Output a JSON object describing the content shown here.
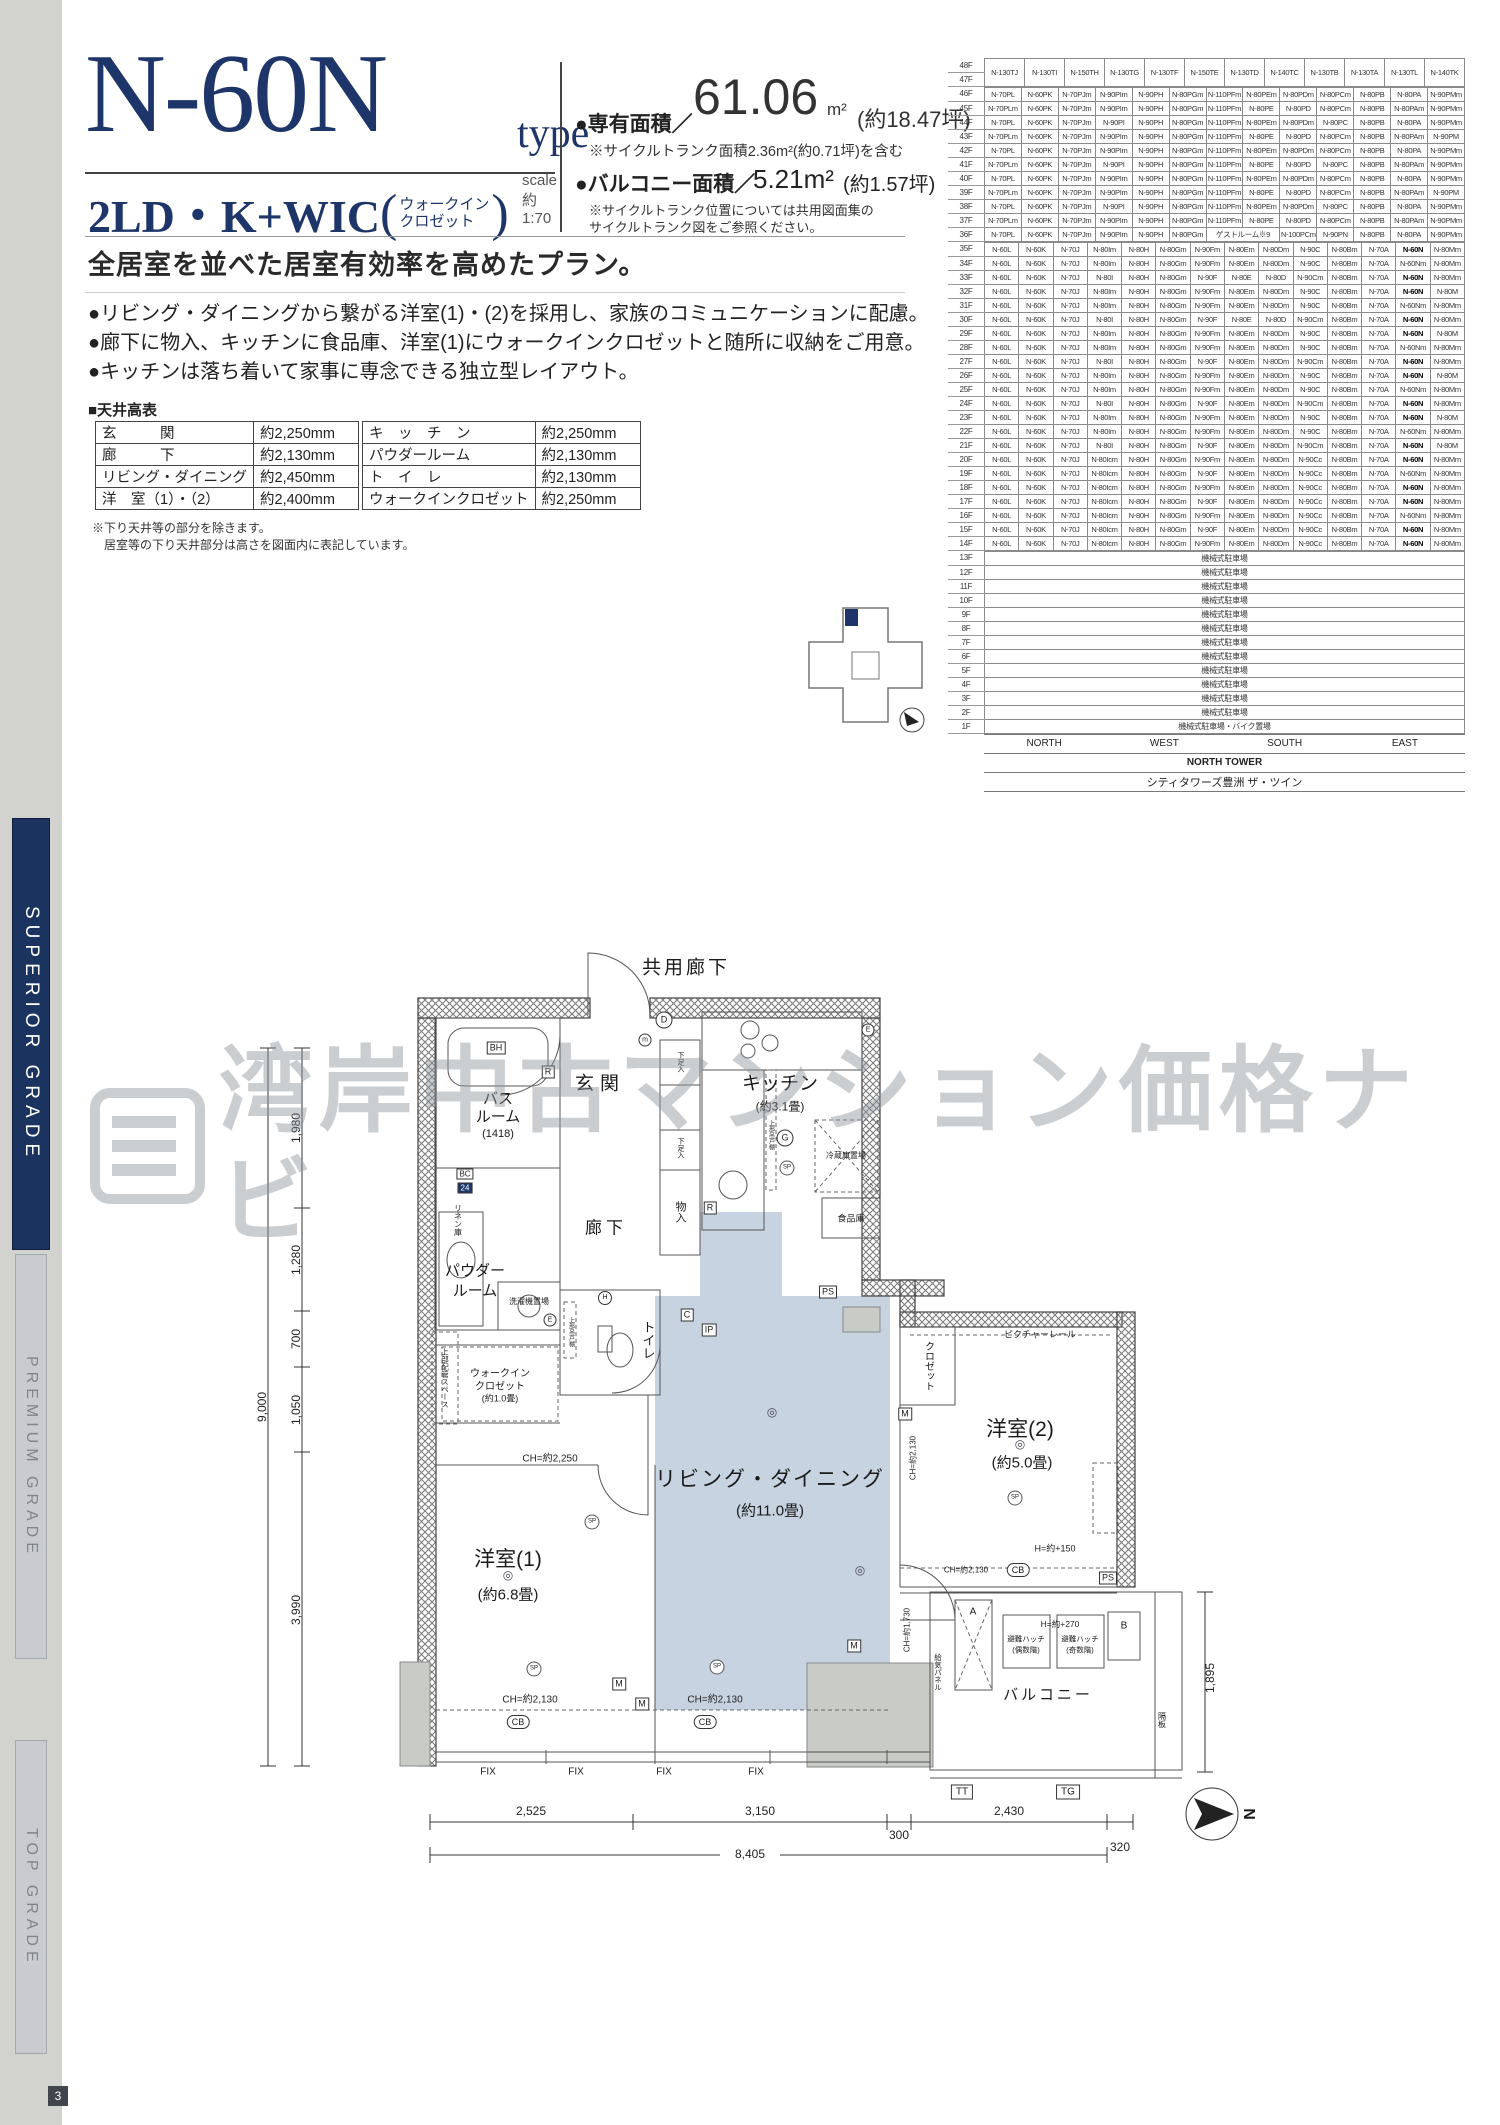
{
  "page": {
    "number": "3"
  },
  "sidebar": {
    "bands": [
      {
        "label": "SUPERIOR GRADE"
      },
      {
        "label": "PREMIUM GRADE"
      },
      {
        "label": "TOP GRADE"
      }
    ]
  },
  "header": {
    "type_name": "N-60N",
    "type_suffix": "type",
    "scale": "scale 約1:70",
    "layout": "2LD・K+WIC",
    "paren_open": "(",
    "paren_close": ")",
    "layout_paren_line1": "ウォークイン",
    "layout_paren_line2": "クロゼット",
    "area_label": "●専有面積／",
    "area_value": "61.06",
    "area_unit": "m²",
    "area_tsubo": "(約18.47坪)",
    "area_note": "※サイクルトランク面積2.36m²(約0.71坪)を含む",
    "balcony_label": "●バルコニー面積／",
    "balcony_value": "5.21m²",
    "balcony_tsubo": "(約1.57坪)",
    "balcony_note1": "※サイクルトランク位置については共用図面集の",
    "balcony_note2": "サイクルトランク図をご参照ください。"
  },
  "description": {
    "headline": "全居室を並べた居室有効率を高めたプラン。",
    "bullets": [
      "●リビング・ダイニングから繋がる洋室(1)・(2)を採用し、家族のコミュニケーションに配慮。",
      "●廊下に物入、キッチンに食品庫、洋室(1)にウォークインクロゼットと随所に収納をご用意。",
      "●キッチンは落ち着いて家事に専念できる独立型レイアウト。"
    ]
  },
  "ceiling_table": {
    "title": "■天井高表",
    "left_rows": [
      [
        "玄　　　関",
        "約2,250mm"
      ],
      [
        "廊　　　下",
        "約2,130mm"
      ],
      [
        "リビング・ダイニング",
        "約2,450mm"
      ],
      [
        "洋　室（1）・（2）",
        "約2,400mm"
      ]
    ],
    "right_rows": [
      [
        "キ　ッ　チ　ン",
        "約2,250mm"
      ],
      [
        "パウダールーム",
        "約2,130mm"
      ],
      [
        "ト　イ　レ",
        "約2,130mm"
      ],
      [
        "ウォークインクロゼット",
        "約2,250mm"
      ]
    ],
    "notes": [
      "※下り天井等の部分を除きます。",
      "　居室等の下り天井部分は高さを図面内に表記しています。"
    ]
  },
  "floor_table": {
    "highlight": "N-60N",
    "penthouse": {
      "floors": [
        "48F",
        "47F"
      ],
      "cells": [
        "N-130TJ",
        "N-130TI",
        "N-150TH",
        "N-130TG",
        "N-130TF",
        "N-150TE",
        "N-130TD",
        "N-140TC",
        "N-130TB",
        "N-130TA",
        "N-130TL",
        "N-140TK"
      ]
    },
    "rows_upper": [
      {
        "floor": "46F",
        "cells": [
          "N-70PL",
          "N-60PK",
          "N-70PJm",
          "N-90PIm",
          "N-90PH",
          "N-80PGm",
          "N-110PFm",
          "N-80PEm",
          "N-80PDm",
          "N-80PCm",
          "N-80PB",
          "N-80PA",
          "N-90PMm"
        ]
      },
      {
        "floor": "45F",
        "cells": [
          "N-70PLm",
          "N-60PK",
          "N-70PJm",
          "N-90PIm",
          "N-90PH",
          "N-80PGm",
          "N-110PFm",
          "N-80PE",
          "N-80PD",
          "N-80PCm",
          "N-80PB",
          "N-80PAm",
          "N-90PMm"
        ]
      },
      {
        "floor": "44F",
        "cells": [
          "N-70PL",
          "N-60PK",
          "N-70PJm",
          "N-90PI",
          "N-90PH",
          "N-80PGm",
          "N-110PFm",
          "N-80PEm",
          "N-80PDm",
          "N-80PC",
          "N-80PB",
          "N-80PA",
          "N-90PMm"
        ]
      },
      {
        "floor": "43F",
        "cells": [
          "N-70PLm",
          "N-60PK",
          "N-70PJm",
          "N-90PIm",
          "N-90PH",
          "N-80PGm",
          "N-110PFm",
          "N-80PE",
          "N-80PD",
          "N-80PCm",
          "N-80PB",
          "N-80PAm",
          "N-90PM"
        ]
      },
      {
        "floor": "42F",
        "cells": [
          "N-70PL",
          "N-60PK",
          "N-70PJm",
          "N-90PIm",
          "N-90PH",
          "N-80PGm",
          "N-110PFm",
          "N-80PEm",
          "N-80PDm",
          "N-80PCm",
          "N-80PB",
          "N-80PA",
          "N-90PMm"
        ]
      },
      {
        "floor": "41F",
        "cells": [
          "N-70PLm",
          "N-60PK",
          "N-70PJm",
          "N-90PI",
          "N-90PH",
          "N-80PGm",
          "N-110PFm",
          "N-80PE",
          "N-80PD",
          "N-80PC",
          "N-80PB",
          "N-80PAm",
          "N-90PMm"
        ]
      },
      {
        "floor": "40F",
        "cells": [
          "N-70PL",
          "N-60PK",
          "N-70PJm",
          "N-90PIm",
          "N-90PH",
          "N-80PGm",
          "N-110PFm",
          "N-80PEm",
          "N-80PDm",
          "N-80PCm",
          "N-80PB",
          "N-80PA",
          "N-90PMm"
        ]
      },
      {
        "floor": "39F",
        "cells": [
          "N-70PLm",
          "N-60PK",
          "N-70PJm",
          "N-90PIm",
          "N-90PH",
          "N-80PGm",
          "N-110PFm",
          "N-80PE",
          "N-80PD",
          "N-80PCm",
          "N-80PB",
          "N-80PAm",
          "N-90PM"
        ]
      },
      {
        "floor": "38F",
        "cells": [
          "N-70PL",
          "N-60PK",
          "N-70PJm",
          "N-90PI",
          "N-90PH",
          "N-80PGm",
          "N-110PFm",
          "N-80PEm",
          "N-80PDm",
          "N-80PC",
          "N-80PB",
          "N-80PA",
          "N-90PMm"
        ]
      },
      {
        "floor": "37F",
        "cells": [
          "N-70PLm",
          "N-60PK",
          "N-70PJm",
          "N-90PIm",
          "N-90PH",
          "N-80PGm",
          "N-110PFm",
          "N-80PE",
          "N-80PD",
          "N-80PCm",
          "N-80PB",
          "N-80PAm",
          "N-90PMm"
        ]
      },
      {
        "floor": "36F",
        "cells": [
          "N-70PL",
          "N-60PK",
          "N-70PJm",
          "N-90PIm",
          "N-90PH",
          "N-80PGm",
          {
            "t": "ゲストルーム※9",
            "s": 2
          },
          "N-100PCm",
          "N-90PN",
          "N-80PB",
          "N-80PA",
          "N-90PMm"
        ]
      }
    ],
    "rows_lower": [
      {
        "floor": "35F",
        "cells": [
          "N-60L",
          "N-60K",
          "N-70J",
          "N-80Im",
          "N-80H",
          "N-80Gm",
          "N-90Fm",
          "N-80Em",
          "N-80Dm",
          "N-90C",
          "N-80Bm",
          "N-70A",
          "N-60N",
          "N-80Mm"
        ]
      },
      {
        "floor": "34F",
        "cells": [
          "N-60L",
          "N-60K",
          "N-70J",
          "N-80Im",
          "N-80H",
          "N-80Gm",
          "N-90Fm",
          "N-80Em",
          "N-80Dm",
          "N-90C",
          "N-80Bm",
          "N-70A",
          "N-60Nm",
          "N-80Mm"
        ]
      },
      {
        "floor": "33F",
        "cells": [
          "N-60L",
          "N-60K",
          "N-70J",
          "N-80I",
          "N-80H",
          "N-80Gm",
          "N-90F",
          "N-80E",
          "N-80D",
          "N-90Cm",
          "N-80Bm",
          "N-70A",
          "N-60N",
          "N-80Mm"
        ]
      },
      {
        "floor": "32F",
        "cells": [
          "N-60L",
          "N-60K",
          "N-70J",
          "N-80Im",
          "N-80H",
          "N-80Gm",
          "N-90Fm",
          "N-80Em",
          "N-80Dm",
          "N-90C",
          "N-80Bm",
          "N-70A",
          "N-60N",
          "N-80M"
        ]
      },
      {
        "floor": "31F",
        "cells": [
          "N-60L",
          "N-60K",
          "N-70J",
          "N-80Im",
          "N-80H",
          "N-80Gm",
          "N-90Fm",
          "N-80Em",
          "N-80Dm",
          "N-90C",
          "N-80Bm",
          "N-70A",
          "N-60Nm",
          "N-80Mm"
        ]
      },
      {
        "floor": "30F",
        "cells": [
          "N-60L",
          "N-60K",
          "N-70J",
          "N-80I",
          "N-80H",
          "N-80Gm",
          "N-90F",
          "N-80E",
          "N-80D",
          "N-90Cm",
          "N-80Bm",
          "N-70A",
          "N-60N",
          "N-80Mm"
        ]
      },
      {
        "floor": "29F",
        "cells": [
          "N-60L",
          "N-60K",
          "N-70J",
          "N-80Im",
          "N-80H",
          "N-80Gm",
          "N-90Fm",
          "N-80Em",
          "N-80Dm",
          "N-90C",
          "N-80Bm",
          "N-70A",
          "N-60N",
          "N-80M"
        ]
      },
      {
        "floor": "28F",
        "cells": [
          "N-60L",
          "N-60K",
          "N-70J",
          "N-80Im",
          "N-80H",
          "N-80Gm",
          "N-90Fm",
          "N-80Em",
          "N-80Dm",
          "N-90C",
          "N-80Bm",
          "N-70A",
          "N-60Nm",
          "N-80Mm"
        ]
      },
      {
        "floor": "27F",
        "cells": [
          "N-60L",
          "N-60K",
          "N-70J",
          "N-80I",
          "N-80H",
          "N-80Gm",
          "N-90F",
          "N-80Em",
          "N-80Dm",
          "N-90Cm",
          "N-80Bm",
          "N-70A",
          "N-60N",
          "N-80Mm"
        ]
      },
      {
        "floor": "26F",
        "cells": [
          "N-60L",
          "N-60K",
          "N-70J",
          "N-80Im",
          "N-80H",
          "N-80Gm",
          "N-90Fm",
          "N-80Em",
          "N-80Dm",
          "N-90C",
          "N-80Bm",
          "N-70A",
          "N-60N",
          "N-80M"
        ]
      },
      {
        "floor": "25F",
        "cells": [
          "N-60L",
          "N-60K",
          "N-70J",
          "N-80Im",
          "N-80H",
          "N-80Gm",
          "N-90Fm",
          "N-80Em",
          "N-80Dm",
          "N-90C",
          "N-80Bm",
          "N-70A",
          "N-60Nm",
          "N-80Mm"
        ]
      },
      {
        "floor": "24F",
        "cells": [
          "N-60L",
          "N-60K",
          "N-70J",
          "N-80I",
          "N-80H",
          "N-80Gm",
          "N-90F",
          "N-80Em",
          "N-80Dm",
          "N-90Cm",
          "N-80Bm",
          "N-70A",
          "N-60N",
          "N-80Mm"
        ]
      },
      {
        "floor": "23F",
        "cells": [
          "N-60L",
          "N-60K",
          "N-70J",
          "N-80Im",
          "N-80H",
          "N-80Gm",
          "N-90Fm",
          "N-80Em",
          "N-80Dm",
          "N-90C",
          "N-80Bm",
          "N-70A",
          "N-60N",
          "N-80M"
        ]
      },
      {
        "floor": "22F",
        "cells": [
          "N-60L",
          "N-60K",
          "N-70J",
          "N-80Im",
          "N-80H",
          "N-80Gm",
          "N-90Fm",
          "N-80Em",
          "N-80Dm",
          "N-90C",
          "N-80Bm",
          "N-70A",
          "N-60Nm",
          "N-80Mm"
        ]
      },
      {
        "floor": "21F",
        "cells": [
          "N-60L",
          "N-60K",
          "N-70J",
          "N-80I",
          "N-80H",
          "N-80Gm",
          "N-90F",
          "N-80Em",
          "N-80Dm",
          "N-90Cm",
          "N-80Bm",
          "N-70A",
          "N-60N",
          "N-80M"
        ]
      },
      {
        "floor": "20F",
        "cells": [
          "N-60L",
          "N-60K",
          "N-70J",
          "N-80Icm",
          "N-80H",
          "N-80Gm",
          "N-90Fm",
          "N-80Em",
          "N-80Dm",
          "N-90Cc",
          "N-80Bm",
          "N-70A",
          "N-60N",
          "N-80Mm"
        ]
      },
      {
        "floor": "19F",
        "cells": [
          "N-60L",
          "N-60K",
          "N-70J",
          "N-80Icm",
          "N-80H",
          "N-80Gm",
          "N-90F",
          "N-80Em",
          "N-80Dm",
          "N-90Cc",
          "N-80Bm",
          "N-70A",
          "N-60Nm",
          "N-80Mm"
        ]
      },
      {
        "floor": "18F",
        "cells": [
          "N-60L",
          "N-60K",
          "N-70J",
          "N-80Icm",
          "N-80H",
          "N-80Gm",
          "N-90Fm",
          "N-80Em",
          "N-80Dm",
          "N-90Cc",
          "N-80Bm",
          "N-70A",
          "N-60N",
          "N-80Mm"
        ]
      },
      {
        "floor": "17F",
        "cells": [
          "N-60L",
          "N-60K",
          "N-70J",
          "N-80Icm",
          "N-80H",
          "N-80Gm",
          "N-90F",
          "N-80Em",
          "N-80Dm",
          "N-90Cc",
          "N-80Bm",
          "N-70A",
          "N-60N",
          "N-80Mm"
        ]
      },
      {
        "floor": "16F",
        "cells": [
          "N-60L",
          "N-60K",
          "N-70J",
          "N-80Icm",
          "N-80H",
          "N-80Gm",
          "N-90Fm",
          "N-80Em",
          "N-80Dm",
          "N-90Cc",
          "N-80Bm",
          "N-70A",
          "N-60Nm",
          "N-80Mm"
        ]
      },
      {
        "floor": "15F",
        "cells": [
          "N-60L",
          "N-60K",
          "N-70J",
          "N-80Icm",
          "N-80H",
          "N-80Gm",
          "N-90F",
          "N-80Em",
          "N-80Dm",
          "N-90Cc",
          "N-80Bm",
          "N-70A",
          "N-60N",
          "N-80Mm"
        ]
      },
      {
        "floor": "14F",
        "cells": [
          "N-60L",
          "N-60K",
          "N-70J",
          "N-80Icm",
          "N-80H",
          "N-80Gm",
          "N-90Fm",
          "N-80Em",
          "N-80Dm",
          "N-90Cc",
          "N-80Bm",
          "N-70A",
          "N-60N",
          "N-80Mm"
        ]
      }
    ],
    "parking_rows": [
      {
        "floor": "13F",
        "label": "機械式駐車場"
      },
      {
        "floor": "12F",
        "label": "機械式駐車場"
      },
      {
        "floor": "11F",
        "label": "機械式駐車場"
      },
      {
        "floor": "10F",
        "label": "機械式駐車場"
      },
      {
        "floor": "9F",
        "label": "機械式駐車場"
      },
      {
        "floor": "8F",
        "label": "機械式駐車場"
      },
      {
        "floor": "7F",
        "label": "機械式駐車場"
      },
      {
        "floor": "6F",
        "label": "機械式駐車場"
      },
      {
        "floor": "5F",
        "label": "機械式駐車場"
      },
      {
        "floor": "4F",
        "label": "機械式駐車場"
      },
      {
        "floor": "3F",
        "label": "機械式駐車場"
      },
      {
        "floor": "2F",
        "label": "機械式駐車場"
      },
      {
        "floor": "1F",
        "label": "機械式駐車場・バイク置場"
      }
    ],
    "directions": [
      "NORTH",
      "WEST",
      "SOUTH",
      "EAST"
    ],
    "tower": "NORTH TOWER",
    "building": "シティタワーズ豊洲 ザ・ツイン"
  },
  "floorplan": {
    "labels": {
      "kyoyo_roka": "共用廊下",
      "genkan": "玄関",
      "bath1": "バス",
      "bath2": "ルーム",
      "bath_size": "(1418)",
      "bh": "BH",
      "bc": "BC",
      "bc24": "24",
      "r": "R",
      "d": "D",
      "m_small": "m",
      "e": "E",
      "g": "G",
      "h": "H",
      "c": "C",
      "ip": "IP",
      "powder1": "パウダー",
      "powder2": "ルーム",
      "linen": "リネン庫",
      "roka": "廊下",
      "toilet": "トイレ",
      "mono_iri": "物入",
      "geta": "下足入",
      "kitchen": "キッチン",
      "kitchen_size": "(約3.1畳)",
      "reizo": "冷蔵庫置場",
      "shokuhin": "食品庫",
      "sentaku": "洗濯機置場",
      "jobu_tsuridana": "上部吊戸棚",
      "jobu_haikan": "上部配管スペース",
      "wic1": "ウォークイン",
      "wic2": "クロゼット",
      "wic_size": "(約1.0畳)",
      "living": "リビング・ダイニング",
      "living_size": "(約11.0畳)",
      "bed1": "洋室(1)",
      "bed1_size": "(約6.8畳)",
      "bed2": "洋室(2)",
      "bed2_size": "(約5.0畳)",
      "closet": "クロゼット",
      "picture_rail": "ピクチャーレール",
      "balcony": "バルコニー",
      "hatch1": "避難ハッチ",
      "hatch_even": "(偶数階)",
      "hatch_odd": "(奇数階)",
      "kyuki": "給気パネル",
      "kakuita": "隔板",
      "ps": "PS",
      "m": "M",
      "sp": "SP",
      "cb": "CB",
      "fix": "FIX",
      "tt": "TT",
      "tg": "TG",
      "a": "A",
      "b": "B",
      "light": "◎"
    },
    "ch": {
      "ch2250": "CH=約2,250",
      "ch2130": "CH=約2,130",
      "ch1730": "CH=約1,730",
      "h150": "H=約+150",
      "h270": "H=約+270"
    },
    "dims": {
      "left": [
        "1,980",
        "1,280",
        "700",
        "1,050",
        "3,990"
      ],
      "left_total": "9,000",
      "bottom": [
        "2,525",
        "3,150",
        "300"
      ],
      "bottom_total": "8,405",
      "right_chain": [
        "2,430",
        "320"
      ],
      "balcony_depth": "1,895",
      "north": "N"
    }
  },
  "watermark": {
    "text": "湾岸中古マンション価格ナビ"
  },
  "colors": {
    "navy": "#1d3569",
    "ld_fill": "#c7d3e0",
    "band_navy": "#1a335f",
    "gray_pillar": "#c9cbc6",
    "wm_gray": "#8d939b"
  }
}
